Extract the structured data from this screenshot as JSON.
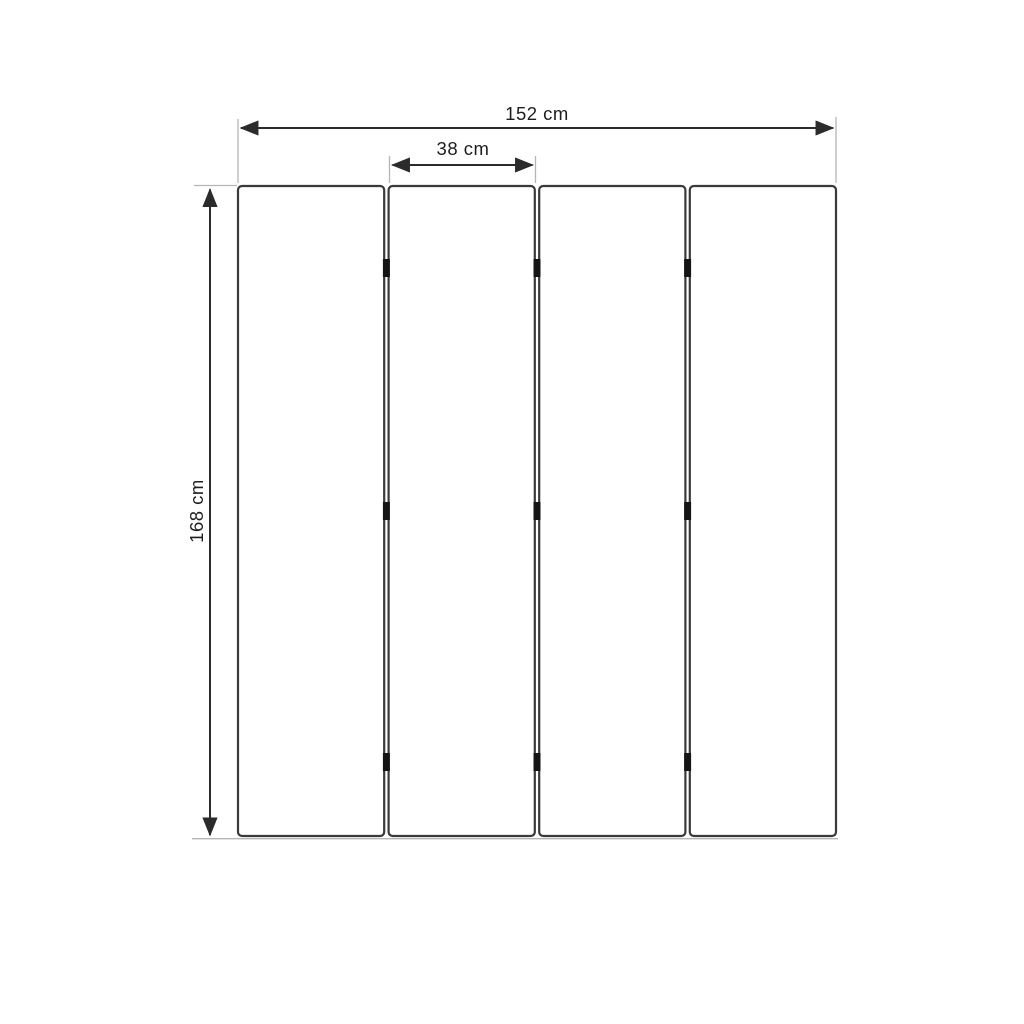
{
  "diagram": {
    "kind": "dimension-drawing",
    "subject": "four-panel folding screen (front view)",
    "panel_count": 4,
    "hinge_marks_per_gap": 3,
    "labels": {
      "total_width": "152 cm",
      "panel_width": "38 cm",
      "height": "168 cm"
    },
    "values": {
      "total_width_cm": 152,
      "panel_width_cm": 38,
      "height_cm": 168,
      "unit": "cm"
    },
    "colors": {
      "background": "#ffffff",
      "panel_fill": "#ffffff",
      "panel_border": "#3a3a3a",
      "dimension_line": "#2b2b2b",
      "extension_line": "#b5b5b5",
      "hinge": "#151515",
      "text": "#1d1d1d"
    }
  }
}
